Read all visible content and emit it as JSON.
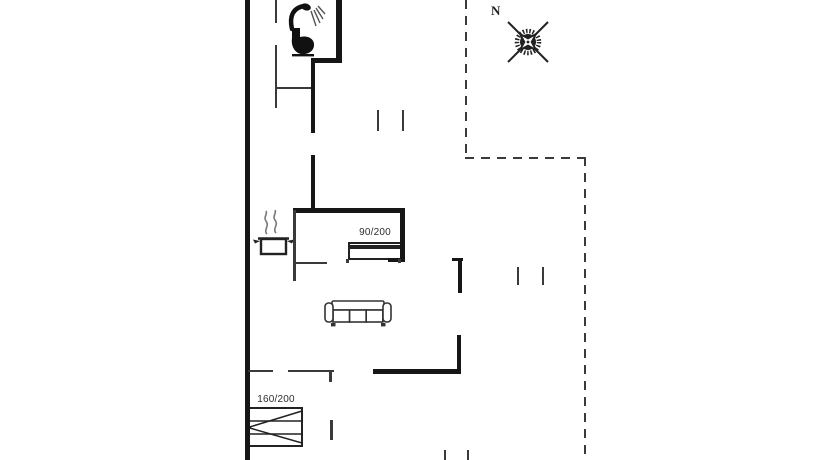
{
  "compass": {
    "north_label": "N"
  },
  "furniture": {
    "bed_single_label": "90/200",
    "bed_double_label": "160/200"
  },
  "colors": {
    "background": "#ffffff",
    "wall": "#161616",
    "thin_line": "#3a3a3a",
    "text": "#2e2e2e"
  },
  "icons": {
    "compass": "compass-rose-icon",
    "shower": "shower-icon",
    "toilet": "toilet-icon",
    "pot": "cooking-pot-icon",
    "sofa": "sofa-icon",
    "bed_single": "single-bed-icon",
    "bed_double": "double-bed-icon"
  },
  "plan": {
    "segments": [
      {
        "name": "exterior-wall-left",
        "kind": "wall",
        "x": 245,
        "y": 0,
        "w": 5,
        "h": 460
      },
      {
        "name": "bathroom-wall-right",
        "kind": "wall",
        "x": 336,
        "y": 0,
        "w": 6,
        "h": 63
      },
      {
        "name": "bathroom-wall-step",
        "kind": "wall",
        "x": 311,
        "y": 58,
        "w": 31,
        "h": 5
      },
      {
        "name": "hall-wall-upper",
        "kind": "wall",
        "x": 311,
        "y": 58,
        "w": 4,
        "h": 75
      },
      {
        "name": "hall-wall-lower",
        "kind": "wall",
        "x": 311,
        "y": 155,
        "w": 4,
        "h": 55
      },
      {
        "name": "bedroom1-wall-top",
        "kind": "wall",
        "x": 293,
        "y": 208,
        "w": 112,
        "h": 5
      },
      {
        "name": "bedroom1-wall-right",
        "kind": "wall",
        "x": 400,
        "y": 208,
        "w": 5,
        "h": 53
      },
      {
        "name": "bedroom1-wall-endcap",
        "kind": "wall",
        "x": 388,
        "y": 258,
        "w": 17,
        "h": 4
      },
      {
        "name": "stub-wall-horizontal",
        "kind": "wall",
        "x": 452,
        "y": 258,
        "w": 11,
        "h": 3
      },
      {
        "name": "stub-wall-vertical",
        "kind": "wall",
        "x": 458,
        "y": 258,
        "w": 4,
        "h": 35
      },
      {
        "name": "living-wall-bottom",
        "kind": "wall",
        "x": 373,
        "y": 369,
        "w": 88,
        "h": 5
      },
      {
        "name": "living-wall-right",
        "kind": "wall",
        "x": 457,
        "y": 335,
        "w": 4,
        "h": 36
      },
      {
        "name": "bathroom-wall-left-upper",
        "kind": "thin",
        "x": 275,
        "y": 0,
        "w": 2,
        "h": 23
      },
      {
        "name": "bathroom-wall-left-lower",
        "kind": "thin",
        "x": 275,
        "y": 45,
        "w": 2,
        "h": 63
      },
      {
        "name": "bathroom-wall-bottom",
        "kind": "thin",
        "x": 277,
        "y": 87,
        "w": 34,
        "h": 2
      },
      {
        "name": "kitchen-wall-left",
        "kind": "thin",
        "x": 293,
        "y": 210,
        "w": 3,
        "h": 71
      },
      {
        "name": "kitchen-wall-bottom",
        "kind": "thin",
        "x": 293,
        "y": 262,
        "w": 34,
        "h": 2
      },
      {
        "name": "bottom-wall-segment-1",
        "kind": "thin",
        "x": 248,
        "y": 370,
        "w": 25,
        "h": 2
      },
      {
        "name": "bottom-wall-segment-2",
        "kind": "thin",
        "x": 288,
        "y": 370,
        "w": 46,
        "h": 2
      },
      {
        "name": "door-jamb-tick",
        "kind": "thin",
        "x": 329,
        "y": 372,
        "w": 3,
        "h": 10
      },
      {
        "name": "bedroom2-window-tick",
        "kind": "thin",
        "x": 330,
        "y": 420,
        "w": 3,
        "h": 20
      },
      {
        "name": "opening-tick-top-1",
        "kind": "thin",
        "x": 377,
        "y": 110,
        "w": 2,
        "h": 21
      },
      {
        "name": "opening-tick-top-2",
        "kind": "thin",
        "x": 402,
        "y": 110,
        "w": 2,
        "h": 21
      },
      {
        "name": "opening-tick-right-1",
        "kind": "thin",
        "x": 517,
        "y": 267,
        "w": 2,
        "h": 18
      },
      {
        "name": "opening-tick-right-2",
        "kind": "thin",
        "x": 542,
        "y": 267,
        "w": 2,
        "h": 18
      },
      {
        "name": "bottom-edge-tick-1",
        "kind": "thin",
        "x": 444,
        "y": 450,
        "w": 2,
        "h": 10
      },
      {
        "name": "bottom-edge-tick-2",
        "kind": "thin",
        "x": 467,
        "y": 450,
        "w": 2,
        "h": 10
      },
      {
        "name": "bed1-foot-left",
        "kind": "thin",
        "x": 346,
        "y": 259,
        "w": 3,
        "h": 4
      },
      {
        "name": "bed1-foot-right",
        "kind": "thin",
        "x": 398,
        "y": 259,
        "w": 3,
        "h": 4
      },
      {
        "name": "terrace-dashed-left",
        "kind": "dash-v",
        "x": 465,
        "y": 0,
        "len": 155
      },
      {
        "name": "terrace-dashed-top",
        "kind": "dash-h",
        "x": 465,
        "y": 157,
        "len": 122
      },
      {
        "name": "terrace-dashed-right",
        "kind": "dash-v",
        "x": 584,
        "y": 157,
        "len": 303
      }
    ]
  }
}
